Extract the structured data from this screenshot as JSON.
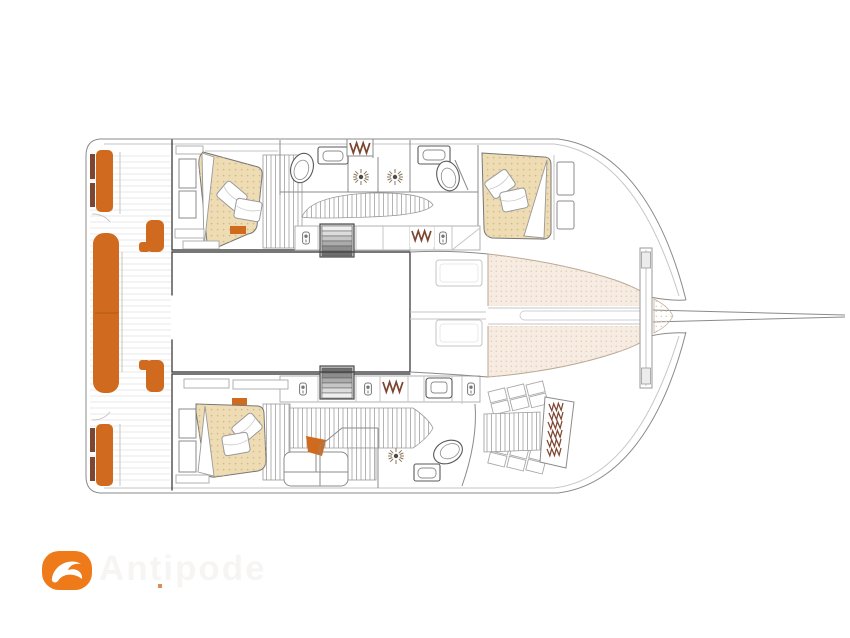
{
  "watermark": {
    "text": "Antipode",
    "logo_icon": "dolphin-icon"
  },
  "colors": {
    "accent_orange": "#d06a1e",
    "logo_orange": "#ee7a1a",
    "upholstery_tan": "#eedcb4",
    "trampoline_beige": "#f6ece1",
    "wood_brown": "#7d4630",
    "line_dark": "#4a4a4a",
    "line_medium": "#8b8b8b",
    "watermark_gray": "#b8b2a6"
  }
}
